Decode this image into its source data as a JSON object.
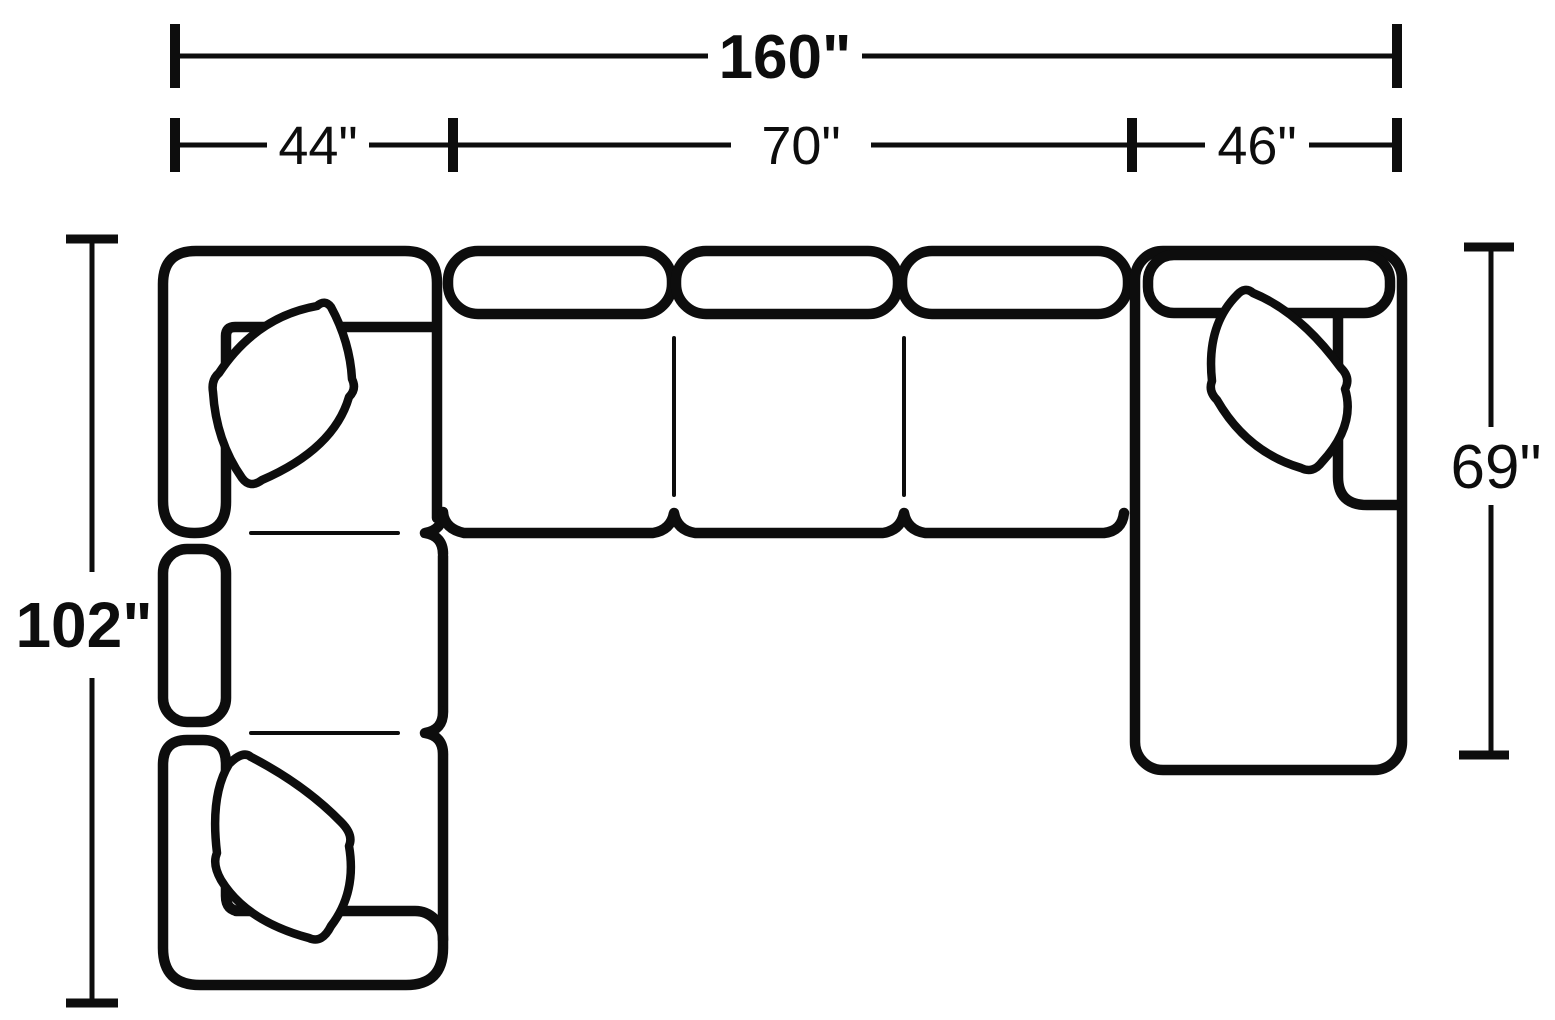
{
  "diagram": {
    "title": "Sectional sofa top-view dimension diagram",
    "unit": "inches",
    "colors": {
      "line": "#0d0d0d",
      "background": "#ffffff"
    },
    "labels": {
      "total_width": "160\"",
      "corner_section_width": "44\"",
      "middle_section_width": "70\"",
      "chaise_section_width": "46\"",
      "left_wing_depth": "102\"",
      "chaise_depth": "69\""
    },
    "values": {
      "total_width_in": 160,
      "corner_section_width_in": 44,
      "middle_section_width_in": 70,
      "chaise_section_width_in": 46,
      "left_wing_depth_in": 102,
      "chaise_depth_in": 69
    }
  }
}
